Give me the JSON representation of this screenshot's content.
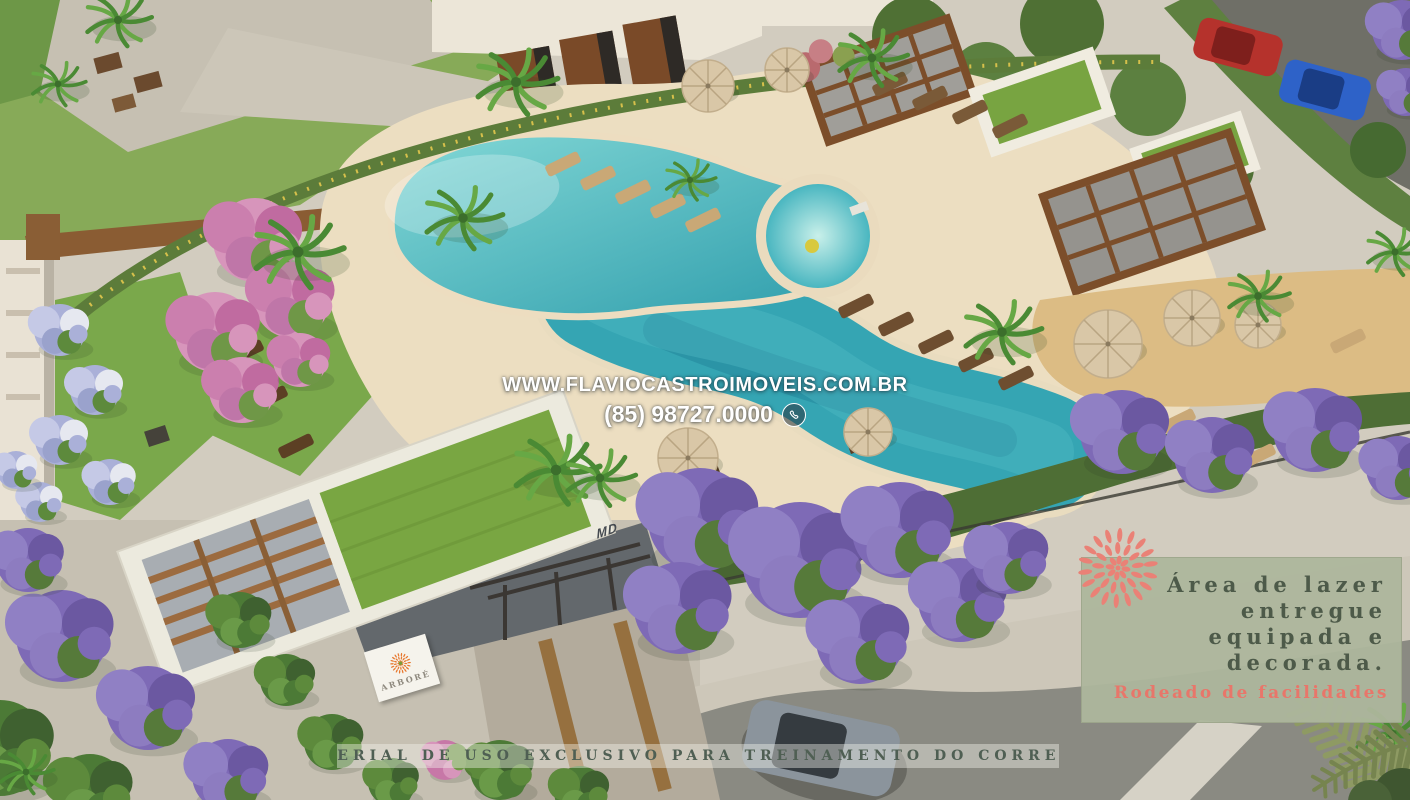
{
  "scene": {
    "type": "aerial-3d-render",
    "subject": "condominium leisure area: freeform pool, pergolas with green roofs, gatehouse, gardens and street",
    "colors": {
      "pool_water": "#2f9fae",
      "pool_shallow": "#7fd6d6",
      "deck_sand": "#ecdec1",
      "paving": "#d2ccbf",
      "lawn": "#7aa84b",
      "green_roof": "#79a642",
      "pergola_wood": "#7c4e2a",
      "jacaranda_purple": "#7e6ab6",
      "pink_tree": "#cb7fae",
      "palm_green": "#4a8a34",
      "overlay_frond_olive": "#8e9a63",
      "car_red": "#b5322c",
      "car_blue": "#2e62c8",
      "car_gray": "#8b949c",
      "street": "#8a8a82"
    }
  },
  "contact": {
    "website": "WWW.FLAVIOCASTROIMOVEIS.COM.BR",
    "phone": "(85) 98727.0000",
    "phone_icon": "phone-circle-icon",
    "text_color": "#ffffff"
  },
  "promo_box": {
    "lines": [
      "Área de lazer",
      "entregue",
      "equipada e",
      "decorada."
    ],
    "highlight_line": "Rodeado de facilidades",
    "background_color": "#adb69c",
    "text_color": "#4d5a49",
    "highlight_color": "#e8766a",
    "starburst_icon": "coral-starburst-icon",
    "starburst_color": "#ea8176"
  },
  "disclaimer": {
    "text": "MATERIAL DE USO EXCLUSIVO PARA TREINAMENTO DO CORRETOR",
    "text_color": "#4f5f53"
  },
  "signage": {
    "entrance_sign_brand": "ARBORÉ",
    "entrance_sign_logo": "orange-starburst-icon",
    "entrance_sign_logo_color": "#e8782e",
    "fascia_mark": "MD"
  }
}
